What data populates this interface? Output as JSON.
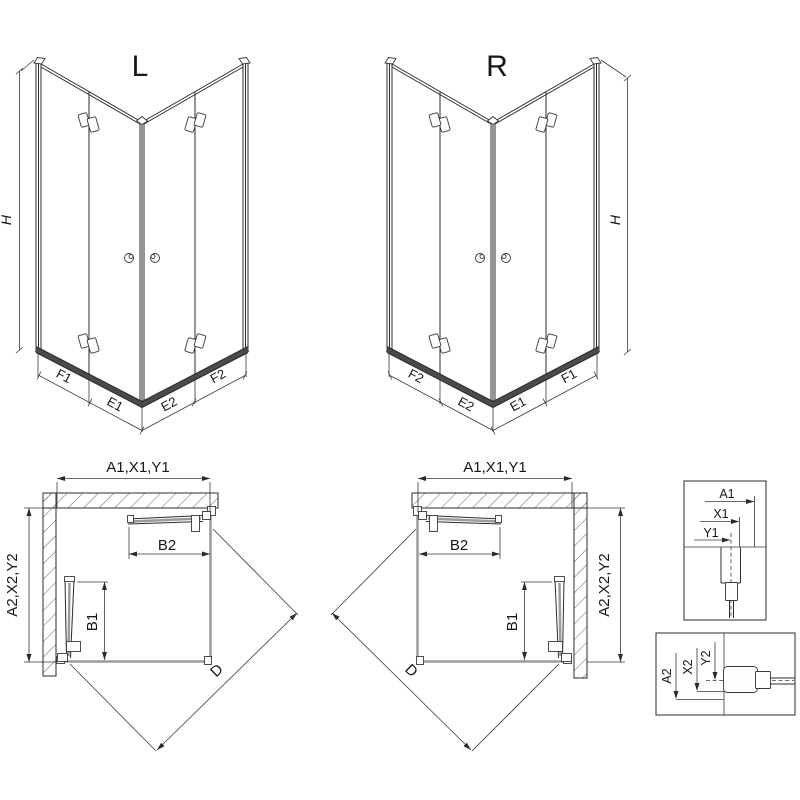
{
  "iso_left": {
    "label": "L",
    "height": "H",
    "seg1": "F1",
    "seg2": "E1",
    "seg3": "E2",
    "seg4": "F2"
  },
  "iso_right": {
    "label": "R",
    "height": "H",
    "seg1": "F2",
    "seg2": "E2",
    "seg3": "E1",
    "seg4": "F1"
  },
  "plan_left": {
    "width": "A1,X1,Y1",
    "side": "A2,X2,Y2",
    "top_door": "B2",
    "side_door": "B1",
    "diag": "D"
  },
  "plan_right": {
    "width": "A1,X1,Y1",
    "side": "A2,X2,Y2",
    "top_door": "B2",
    "side_door": "B1",
    "diag": "D"
  },
  "detail_top": {
    "d1": "A1",
    "d2": "X1",
    "d3": "Y1"
  },
  "detail_bottom": {
    "d1": "A2",
    "d2": "X2",
    "d3": "Y2"
  },
  "colors": {
    "line": "#2b2b2b",
    "glass_gray": "#9b9b9b",
    "background": "#ffffff"
  }
}
